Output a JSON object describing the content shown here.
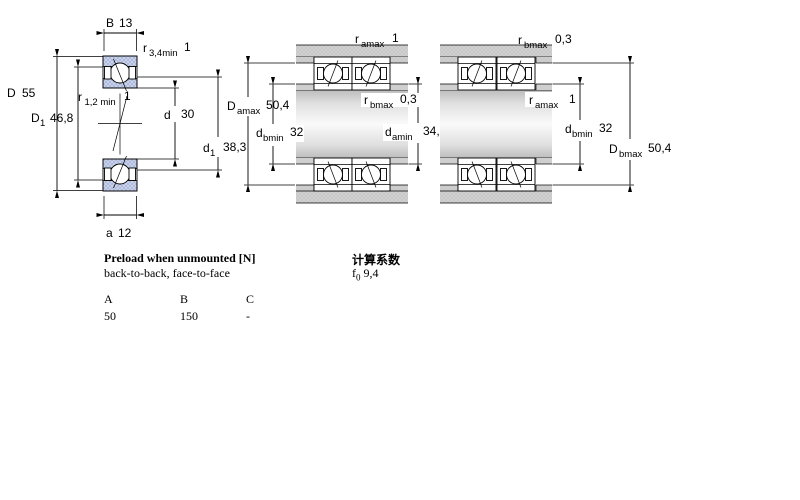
{
  "drawing": {
    "left_view": {
      "B": {
        "sym": "B",
        "value": "13"
      },
      "r34min": {
        "sym": "r",
        "sub": "3,4min",
        "value": "1"
      },
      "D": {
        "sym": "D",
        "value": "55"
      },
      "D1": {
        "sym": "D",
        "sub": "1",
        "value": "46,8"
      },
      "r12min": {
        "sym": "r",
        "sub": "1,2 min",
        "value": "1"
      },
      "d": {
        "sym": "d",
        "value": "30"
      },
      "d1": {
        "sym": "d",
        "sub": "1",
        "value": "38,3"
      },
      "a": {
        "sym": "a",
        "value": "12"
      }
    },
    "back_to_back_view": {
      "ramax": {
        "sym": "r",
        "sub": "amax",
        "value": "1"
      },
      "Damax": {
        "sym": "D",
        "sub": "amax",
        "value": "50,4"
      },
      "rbmax": {
        "sym": "r",
        "sub": "bmax",
        "value": "0,3"
      },
      "dbmin": {
        "sym": "d",
        "sub": "bmin",
        "value": "32"
      },
      "damin": {
        "sym": "d",
        "sub": "amin",
        "value": "34,6"
      }
    },
    "face_to_face_view": {
      "rbmax": {
        "sym": "r",
        "sub": "bmax",
        "value": "0,3"
      },
      "ramax": {
        "sym": "r",
        "sub": "amax",
        "value": "1"
      },
      "dbmin": {
        "sym": "d",
        "sub": "bmin",
        "value": "32"
      },
      "Dbmax": {
        "sym": "D",
        "sub": "bmax",
        "value": "50,4"
      }
    },
    "colors": {
      "ring_fill": "#cdd6ec",
      "ring_hatch": "#9dabd3",
      "steel_fill": "#c7c7c7",
      "line": "#000000"
    }
  },
  "preload": {
    "title": "Preload when unmounted [N]",
    "subtitle": "back-to-back, face-to-face",
    "columns": [
      "A",
      "B",
      "C"
    ],
    "values": [
      "50",
      "150",
      "-"
    ]
  },
  "calculation": {
    "title": "计算系数",
    "f0": {
      "sym": "f",
      "sub": "0",
      "value": "9,4"
    }
  }
}
